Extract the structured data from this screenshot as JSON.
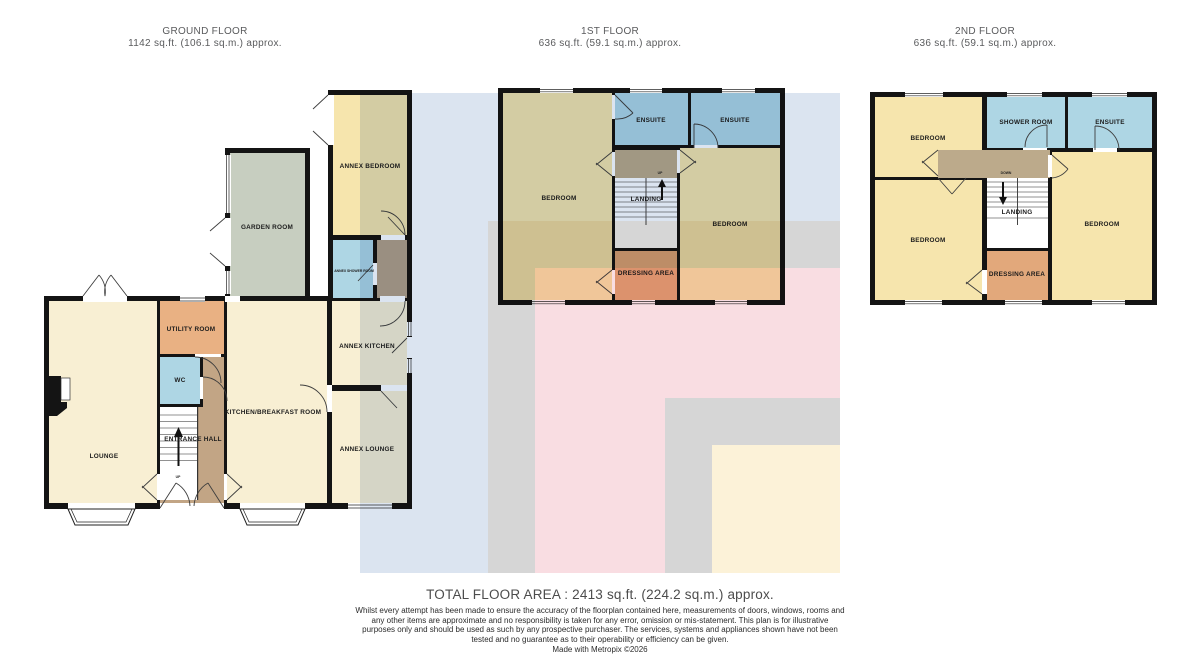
{
  "floors": [
    {
      "id": "ground",
      "title": "GROUND FLOOR",
      "area": "1142 sq.ft. (106.1 sq.m.) approx.",
      "rooms": {
        "annex_bedroom": "ANNEX BEDROOM",
        "garden_room": "GARDEN ROOM",
        "annex_shower_room": "ANNEX SHOWER ROOM",
        "utility_room": "UTILITY ROOM",
        "wc": "WC",
        "entrance_hall": "ENTRANCE HALL",
        "lounge": "LOUNGE",
        "kitchen_breakfast_room": "KITCHEN/BREAKFAST ROOM",
        "annex_kitchen": "ANNEX KITCHEN",
        "annex_lounge": "ANNEX LOUNGE",
        "up": "UP"
      }
    },
    {
      "id": "first",
      "title": "1ST FLOOR",
      "area": "636 sq.ft. (59.1 sq.m.) approx.",
      "rooms": {
        "bedroom_left": "BEDROOM",
        "ensuite_left": "ENSUITE",
        "ensuite_right": "ENSUITE",
        "landing": "LANDING",
        "bedroom_right": "BEDROOM",
        "dressing_area": "DRESSING AREA",
        "up": "UP"
      }
    },
    {
      "id": "second",
      "title": "2ND FLOOR",
      "area": "636 sq.ft. (59.1 sq.m.) approx.",
      "rooms": {
        "bedroom_top_left": "BEDROOM",
        "shower_room": "SHOWER ROOM",
        "ensuite": "ENSUITE",
        "landing": "LANDING",
        "bedroom_bottom_left": "BEDROOM",
        "bedroom_right": "BEDROOM",
        "dressing_area": "DRESSING AREA",
        "down": "DOWN"
      }
    }
  ],
  "footer": {
    "total": "TOTAL FLOOR AREA : 2413 sq.ft. (224.2 sq.m.) approx.",
    "disclaimer": "Whilst every attempt has been made to ensure the accuracy of the floorplan contained here, measurements of doors, windows, rooms and any other items are approximate and no responsibility is taken for any error, omission or mis-statement. This plan is for illustrative purposes only and should be used as such by any prospective purchaser. The services, systems and appliances shown have not been tested and no guarantee as to their operability or efficiency can be given.",
    "credit": "Made with Metropix ©2026"
  },
  "colors": {
    "wall": "#141414",
    "room_cream": "#f8efd3",
    "room_yellow": "#f6e5ad",
    "room_blue": "#aed6e4",
    "room_utility_orange": "#e9b183",
    "room_dressing_orange": "#e2a87b",
    "room_hall_brown": "#c2a585",
    "room_landing_brown": "#bcaa8b",
    "room_lobby_brown": "#b3a089",
    "room_sage": "#c7cec0",
    "bg_blue": "#dbe4f0",
    "bg_grey": "#d6d6d6",
    "bg_pink": "#f9dde2",
    "bg_cream": "#fcf2d8"
  }
}
